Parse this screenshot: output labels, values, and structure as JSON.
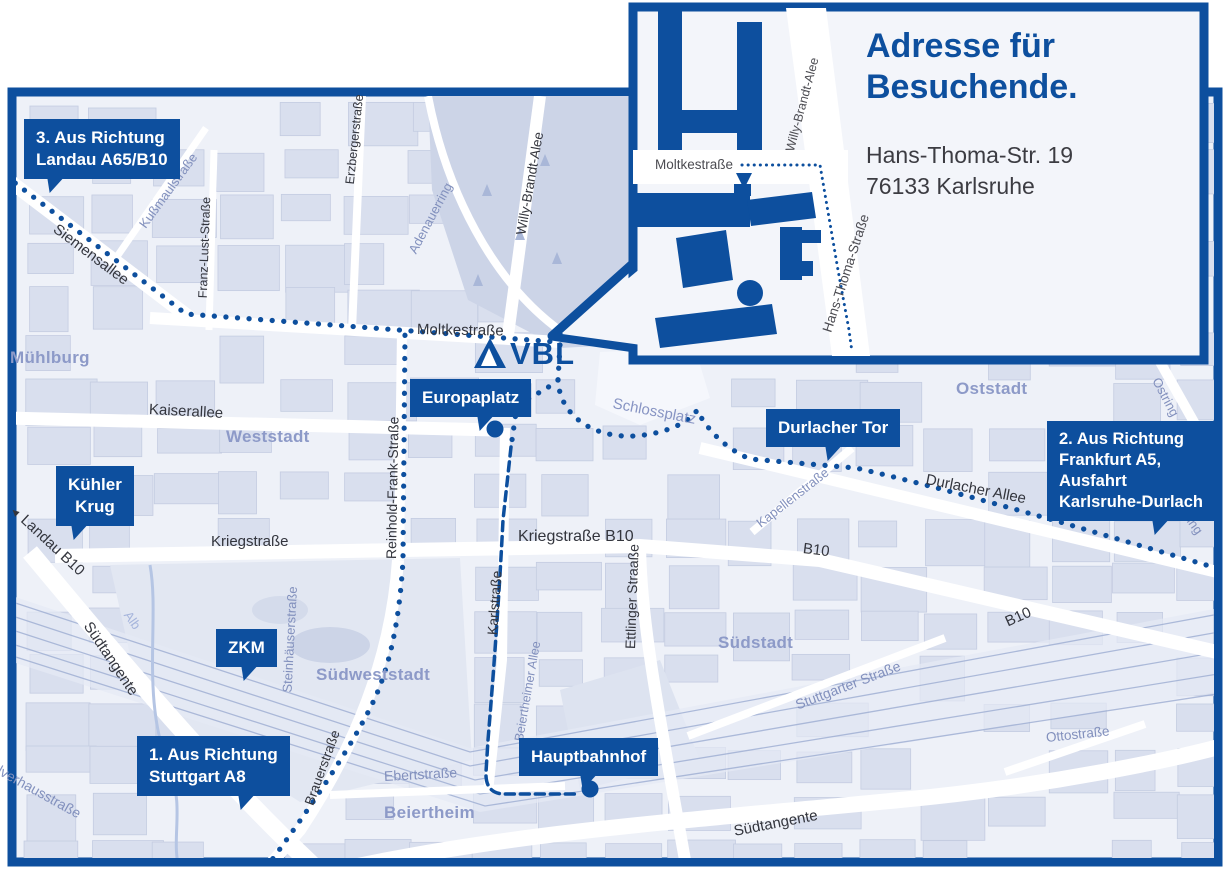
{
  "logo": {
    "text": "VBL"
  },
  "inset": {
    "title_lines": [
      "Adresse für",
      "Besuchende."
    ],
    "address_lines": [
      "Hans-Thoma-Str. 19",
      "76133 Karlsruhe"
    ],
    "streets": {
      "moltkestrasse": "Moltkestraße",
      "willy_brandt_allee": "Willy-Brandt-Alee",
      "hans_thoma_strasse": "Hans-Thoma-Straße"
    }
  },
  "callouts": {
    "richtung3": {
      "lines": [
        "3. Aus Richtung",
        "Landau A65/B10"
      ]
    },
    "kuehler_krug": {
      "lines": [
        "Kühler",
        "Krug"
      ]
    },
    "zkm": {
      "lines": [
        "ZKM"
      ]
    },
    "richtung1": {
      "lines": [
        "1. Aus Richtung",
        "Stuttgart A8"
      ]
    },
    "europaplatz": {
      "lines": [
        "Europaplatz"
      ]
    },
    "durlacher_tor": {
      "lines": [
        "Durlacher Tor"
      ]
    },
    "hauptbahnhof": {
      "lines": [
        "Hauptbahnhof"
      ]
    },
    "richtung2": {
      "lines": [
        "2. Aus Richtung",
        "Frankfurt A5,",
        "Ausfahrt",
        "Karlsruhe-Durlach"
      ]
    }
  },
  "streets": {
    "siemensallee": "Siemensallee",
    "moltkestrasse": "Moltkestraße",
    "kaiserallee": "Kaiserallee",
    "kriegstrasse": "Kriegstraße",
    "kriegstrasse_b10": "Kriegstraße B10",
    "reinhold_frank_strasse": "Reinhold-Frank-Straße",
    "karlstrasse": "Karlstraße",
    "ettlinger_strasse": "Ettlinger Straaße",
    "willy_brandt_allee": "Willy-Brandt-Alee",
    "erzbergerstrasse": "Erzbergerstraße",
    "franz_lust_strasse": "Franz-Lust-Straße",
    "kussmaulstrasse": "Kußmaulstraße",
    "adenauerring": "Adenauerring",
    "kapellenstrasse": "Kapellenstraße",
    "schlossplatz": "Schlossplatz",
    "durlacher_allee": "Durlacher Allee",
    "ostring": "Ostring",
    "b10": "B10",
    "landau_b10": "Landau B10",
    "suedtangente": "Südtangente",
    "brauerstrasse": "Brauerstraße",
    "ebertstrasse": "Ebertstraße",
    "steinhaeuserstrasse": "Steinhäuserstraße",
    "beiertheimer_allee": "Beiertheimer Allee",
    "stuttgarter_strasse": "Stuttgarter Straße",
    "ottostrasse": "Ottostraße",
    "pulverhausstrasse": "Pulverhausstraße",
    "alb": "Alb"
  },
  "districts": {
    "muehlburg": "Mühlburg",
    "weststadt": "Weststadt",
    "oststadt": "Oststadt",
    "suedstadt": "Südstadt",
    "suedweststadt": "Südweststadt",
    "beiertheim": "Beiertheim"
  },
  "markers": {
    "landau_arrow": "◄"
  },
  "colors": {
    "accent_blue": "#0d4f9e",
    "map_background": "#eef1f8",
    "block_fill": "#d9dfee",
    "district_label": "#8d9ac8",
    "street_label_dark": "#33353d",
    "street_label_blue": "#8290bd",
    "white_road": "#ffffff"
  }
}
